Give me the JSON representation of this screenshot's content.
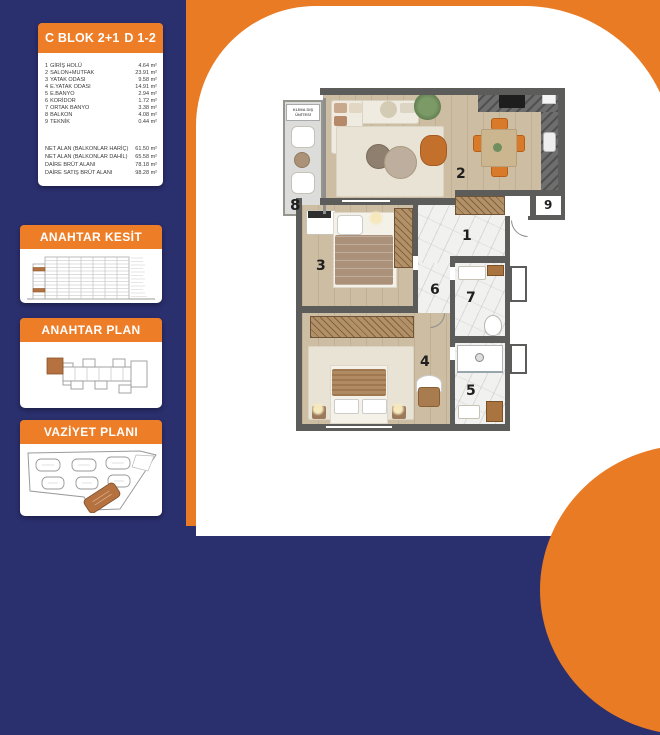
{
  "unit_card": {
    "block_title": "C BLOK 2+1",
    "unit_title": "D 1-2",
    "rooms": [
      {
        "no": "1",
        "name": "GİRİŞ HOLÜ",
        "area": "4.64 m²"
      },
      {
        "no": "2",
        "name": "SALON+MUTFAK",
        "area": "23.91 m²"
      },
      {
        "no": "3",
        "name": "YATAK ODASI",
        "area": "9.58 m²"
      },
      {
        "no": "4",
        "name": "E.YATAK ODASI",
        "area": "14.91 m²"
      },
      {
        "no": "5",
        "name": "E.BANYO",
        "area": "2.94 m²"
      },
      {
        "no": "6",
        "name": "KORİDOR",
        "area": "1.72 m²"
      },
      {
        "no": "7",
        "name": "ORTAK BANYO",
        "area": "3.38 m²"
      },
      {
        "no": "8",
        "name": "BALKON",
        "area": "4.08 m²"
      },
      {
        "no": "9",
        "name": "TEKNİK",
        "area": "0.44 m²"
      }
    ],
    "summary": [
      {
        "label": "NET ALAN (BALKONLAR HARİÇ)",
        "value": "61.50 m²"
      },
      {
        "label": "NET ALAN (BALKONLAR DAHİL)",
        "value": "65.58 m²"
      },
      {
        "label": "DAİRE BRÜT ALANI",
        "value": "78.18 m²"
      },
      {
        "label": "DAİRE SATIŞ BRÜT ALANI",
        "value": "98.28 m²"
      }
    ]
  },
  "section_cards": {
    "kesit_title": "ANAHTAR KESİT",
    "plan_title": "ANAHTAR PLAN",
    "vaziyet_title": "VAZİYET PLANI"
  },
  "floor_plan": {
    "klima_label": "KLİMA DIŞ ÜNİTESİ",
    "room_numbers": [
      "1",
      "2",
      "3",
      "4",
      "5",
      "6",
      "7",
      "8",
      "9"
    ]
  },
  "colors": {
    "navy": "#2A2F6D",
    "orange": "#E97B25",
    "header_orange": "#EE7D28",
    "highlight_unit": "#B5713F",
    "wall": "#5C5C5B"
  }
}
